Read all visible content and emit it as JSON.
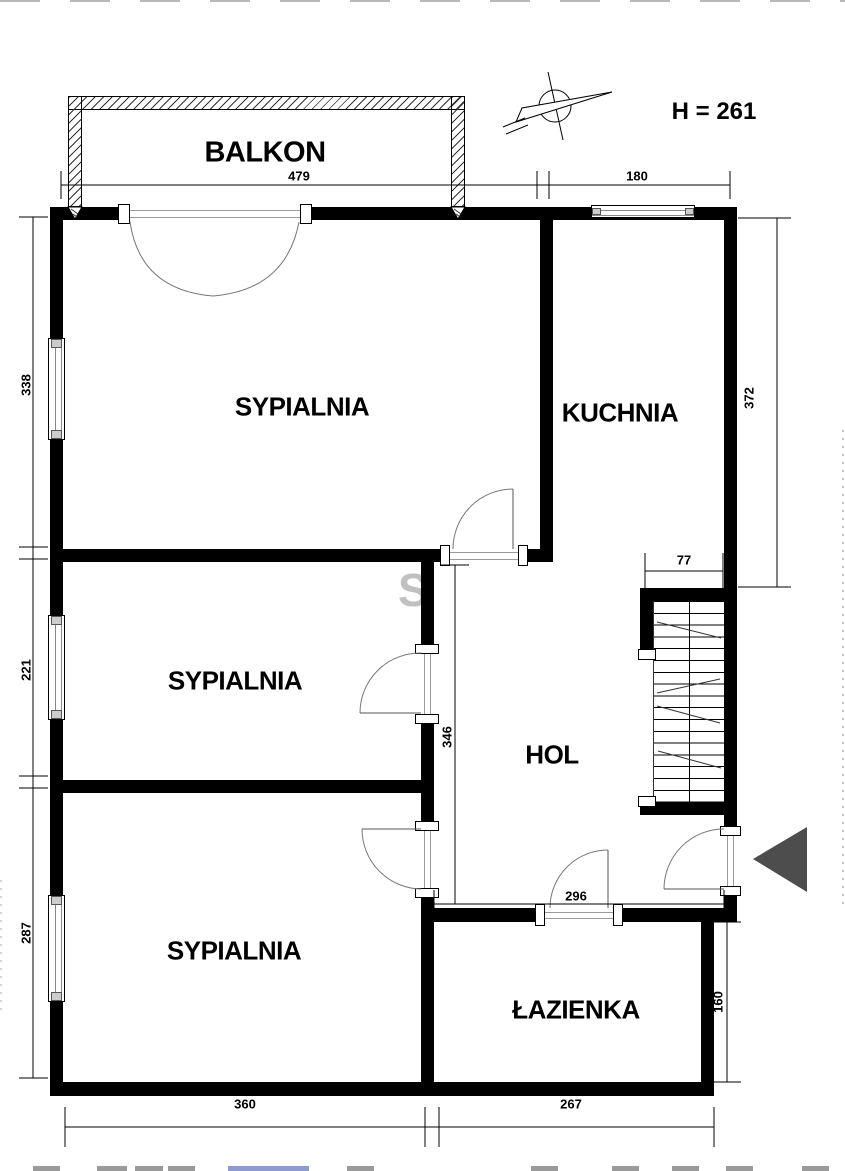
{
  "annotations": {
    "height_text": "H = 261"
  },
  "rooms": {
    "balkon": {
      "label": "BALKON"
    },
    "sypialnia1": {
      "label": "SYPIALNIA"
    },
    "kuchnia": {
      "label": "KUCHNIA"
    },
    "sypialnia2": {
      "label": "SYPIALNIA"
    },
    "hol": {
      "label": "HOL"
    },
    "sypialnia3": {
      "label": "SYPIALNIA"
    },
    "lazienka": {
      "label": "ŁAZIENKA"
    }
  },
  "dimensions_cm": {
    "balcony_width": "479",
    "kitchen_width": "180",
    "bedroom1_depth": "338",
    "bedroom2_depth": "221",
    "bedroom3_depth": "287",
    "kitchen_depth": "372",
    "stairs_width": "77",
    "hall_depth": "346",
    "hall_width": "296",
    "bathroom_depth": "160",
    "bedroom3_width": "360",
    "bathroom_width": "267"
  },
  "watermark": {
    "letter": "S"
  },
  "icons": {
    "north_arrow": "north-arrow-icon",
    "entrance_arrow": "entrance-arrow-icon"
  },
  "colors": {
    "wall": "#000000",
    "door_arc": "#777777",
    "entrance_arrow": "#4d4d4d",
    "watermark": "#c0c0c0"
  }
}
